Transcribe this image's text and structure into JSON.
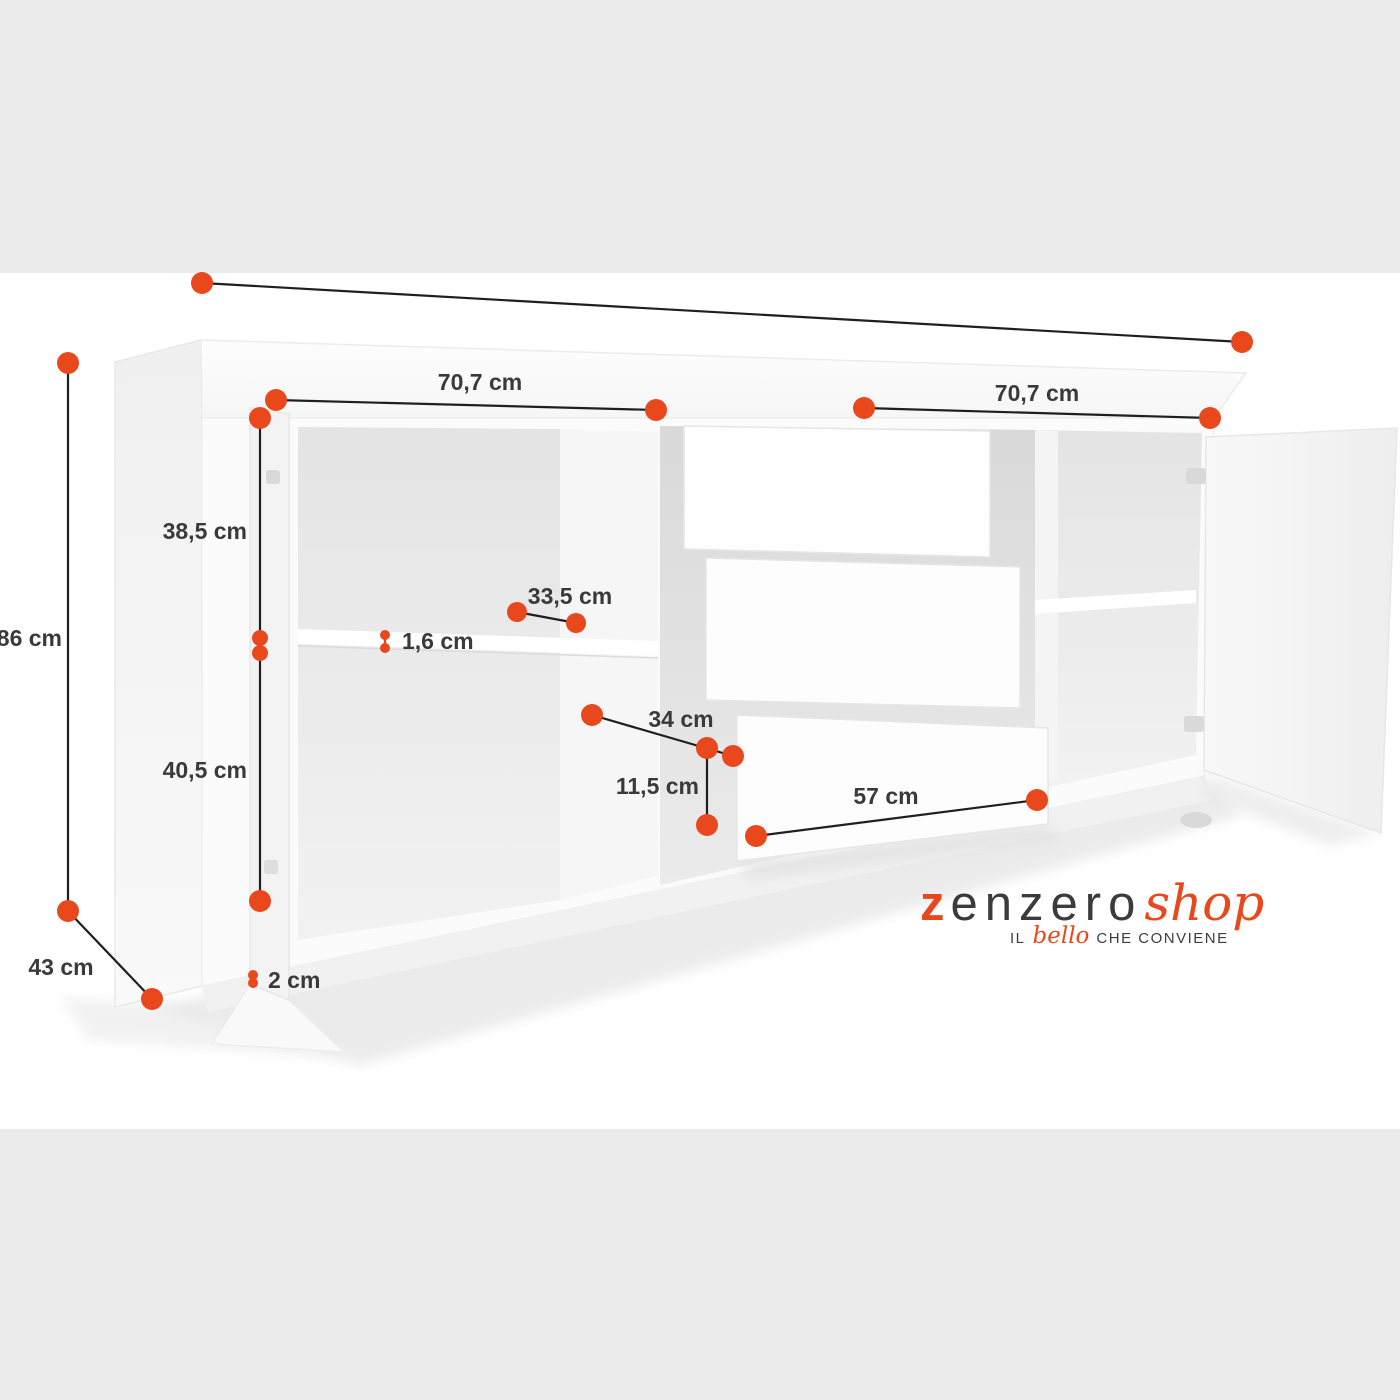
{
  "page": {
    "background": "#FFFFFF",
    "band_color": "#EBEBEB"
  },
  "colors": {
    "accent_orange": "#E8481C",
    "dimension_line": "#1F1F1F",
    "label_text": "#3A3A3A",
    "cabinet_white": "#FBFBFB",
    "interior_gray": "#E6E6E6"
  },
  "labels": {
    "width_left": "70,7 cm",
    "width_right": "70,7 cm",
    "height": "86 cm",
    "upper_section_height": "38,5 cm",
    "lower_section_height": "40,5 cm",
    "shelf_depth": "33,5 cm",
    "shelf_thickness": "1,6 cm",
    "drawer_depth": "34 cm",
    "drawer_inner_height": "11,5 cm",
    "drawer_width": "57 cm",
    "depth": "43 cm",
    "plinth_height": "2 cm"
  },
  "logo": {
    "z": "z",
    "enzero": "enzero",
    "shop": "shop",
    "tagline_prefix": "IL",
    "tagline_accent": "bello",
    "tagline_suffix": "CHE CONVIENE"
  }
}
